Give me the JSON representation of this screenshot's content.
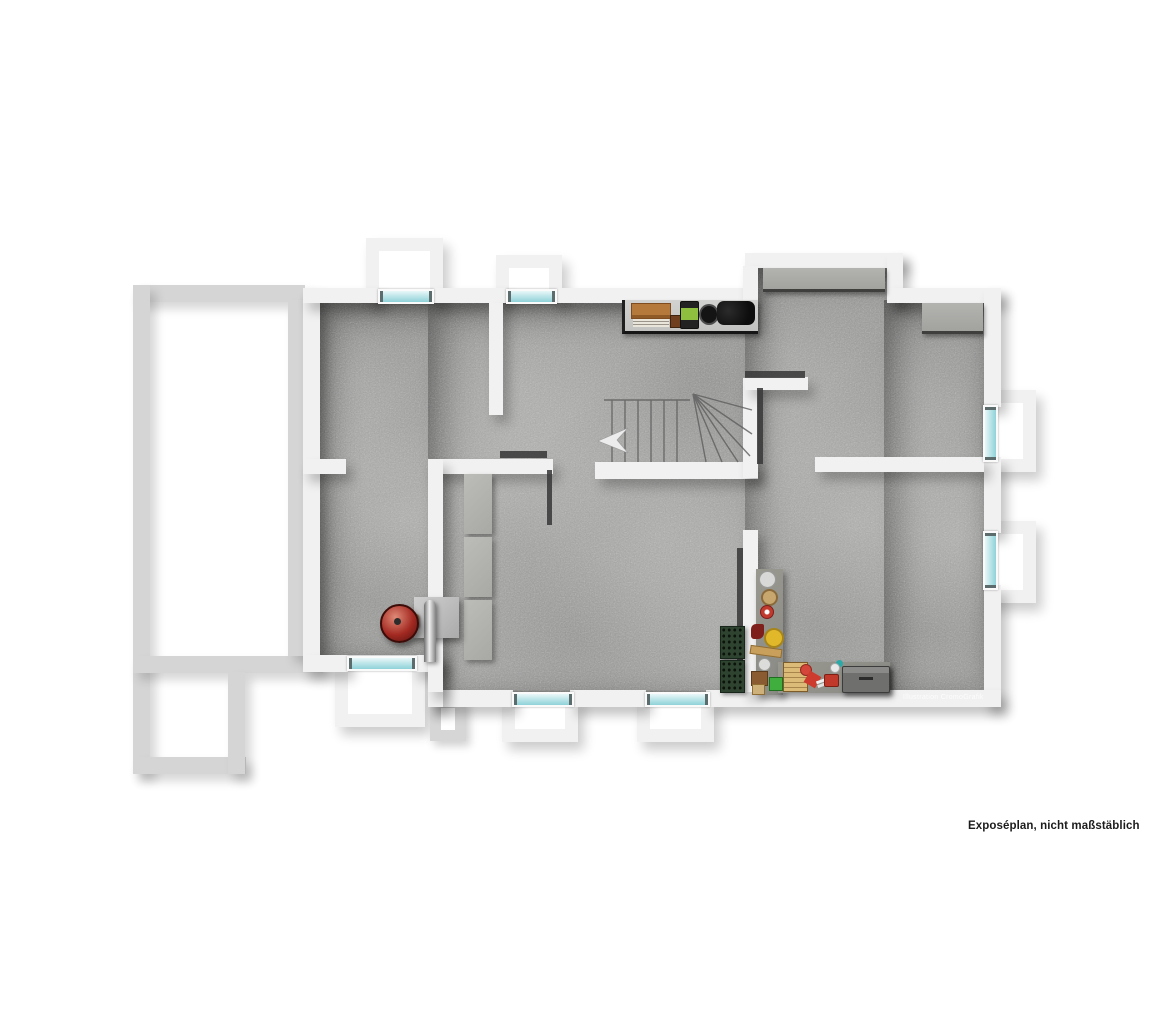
{
  "caption": "Exposéplan, nicht maßstäblich",
  "watermark": "Illustration CromoGrafik",
  "plan": {
    "type": "floor-plan-3d-top-view",
    "floor_material": "concrete",
    "colors": {
      "background": "#ffffff",
      "exterior_outline": "#d5d5d5",
      "wall": "#f1f1f1",
      "floor": "#a4a4a2",
      "window_glass": "#bfe6e9",
      "dark_wall_accent": "#3a3a3a",
      "boiler_red": "#a32a22",
      "bottle_crate_green": "#2f4430",
      "wood_crate": "#b5793c",
      "machine_green": "#8fbf3f",
      "paint_can_yellow": "#e0b82a",
      "toolbox_red": "#c0392b",
      "tool_chest_gray": "#787876"
    },
    "objects": [
      "stairs-with-winder",
      "direction-arrow",
      "storage-shelf-with-items",
      "concrete-sideboards",
      "heating-boiler-red",
      "furnace-box-with-pipe",
      "stacked-storage-blocks",
      "bottle-crates",
      "l-shaped-workbench-with-tools",
      "light-well-windows"
    ]
  }
}
